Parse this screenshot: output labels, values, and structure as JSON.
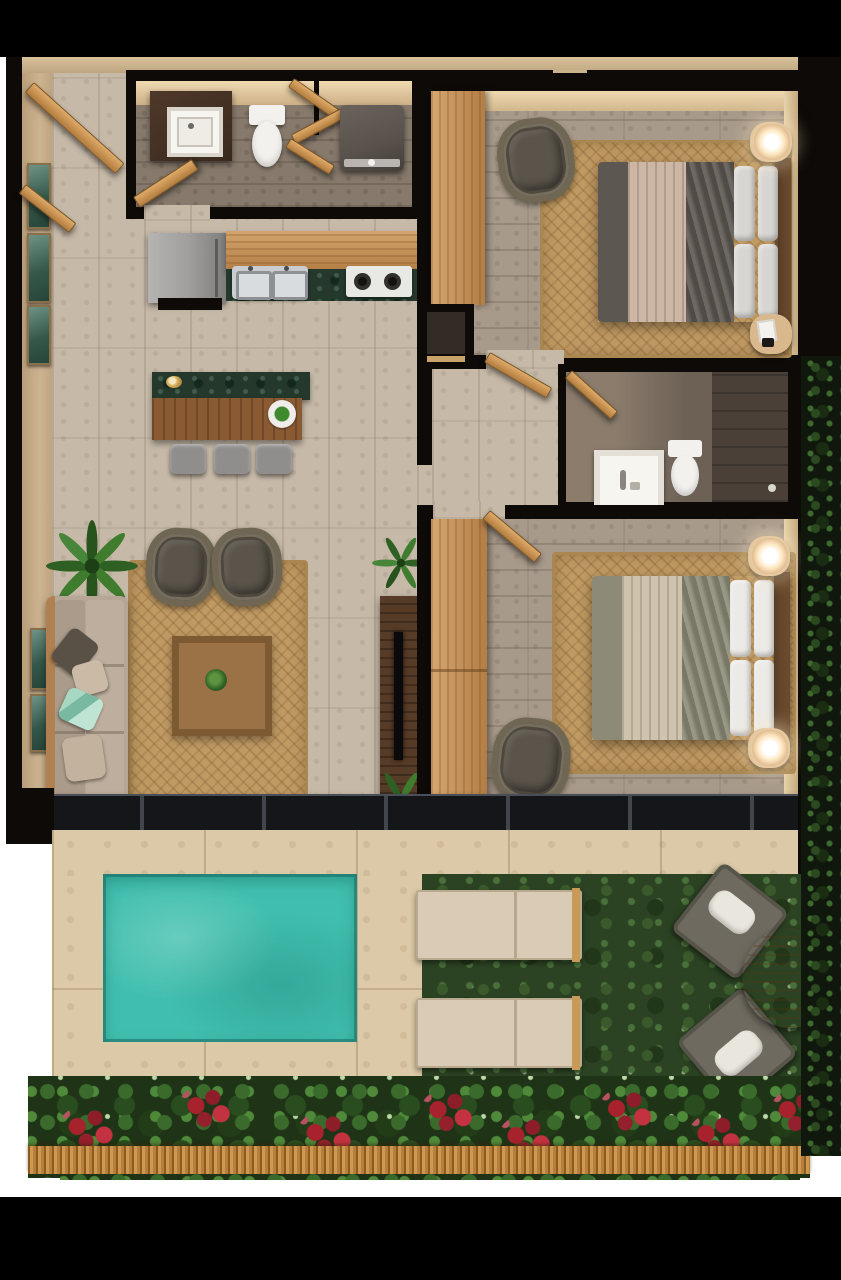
{
  "scene": {
    "description": "top-down 3D render of a two-bedroom, two-bath apartment floor plan with private plunge pool, stone terrace and landscaped garden",
    "render_type": "architectural floor plan, no text labels"
  },
  "palette": {
    "letterbox": "#000000",
    "wall": "#0d0a07",
    "wall_beige": "#cdb491",
    "wall_face": "#e6d0ab",
    "floor_living": "#c6b9a8",
    "floor_bedroom": "#a89a8a",
    "floor_bath1": "#877a6c",
    "floor_bath2": "#6d6156",
    "rug_jute": "#c09a63",
    "wood_light": "#c79054",
    "wood_mid": "#8a5a33",
    "wood_dark": "#563b26",
    "marble_green": "#24382c",
    "fridge": "#9e9d9b",
    "steel": "#c9cdcf",
    "white_fixture": "#f2f1ed",
    "washer": "#59524c",
    "sofa": "#b5a695",
    "armchair": "#4f483e",
    "bed1_duvet": "#5d5751",
    "bed1_throw": "#cdb6a4",
    "bed2_duvet": "#8d8b78",
    "bed2_throw": "#cfc3ad",
    "pillow_light": "#d8d6d2",
    "lamp_glow": "#ffe9c4",
    "tv_black": "#0a0a0a",
    "slider_dark": "#15161a",
    "deck": "#dcc9a7",
    "pool": "#41bfae",
    "grass": "#2c4323",
    "hedge": "#10180d",
    "lounger": "#d9cbb5",
    "chair_gray": "#6e6a5f",
    "cushion_white": "#e9e6de",
    "table_wood": "#b07a42",
    "flower_red": "#a8222e",
    "thatch": "#c28d4b",
    "plant_green": "#3f7a35"
  },
  "areas": {
    "entry_hall": {
      "items": [
        "entry-door-open",
        "wall-art-panels x3"
      ]
    },
    "bathroom_1": {
      "items": [
        "wood-vanity-with-square-sink",
        "toilet",
        "wood-towel-ladder",
        "washer",
        "swing-door"
      ]
    },
    "kitchen": {
      "items": [
        "refrigerator",
        "oak-counter",
        "double-steel-sink",
        "two-burner-stove",
        "green-marble-backsplash"
      ]
    },
    "dining": {
      "items": [
        "green-marble-bar",
        "wood-dining-table",
        "stools x3",
        "serving-plate",
        "flower-decor"
      ]
    },
    "living_room": {
      "items": [
        "beige-sofa",
        "throw-pillows x4",
        "potted-palm",
        "wicker-armchairs x2",
        "jute-rug",
        "wood-coffee-table-with-plant",
        "tv-console",
        "tv",
        "palm-plants x2"
      ]
    },
    "hallway": {
      "items": [
        "tall-oak-cabinet",
        "storage-niche"
      ]
    },
    "bedroom_1": {
      "items": [
        "oak-wardrobe",
        "double-bed",
        "gray-duvet",
        "blush-pleated-throw",
        "pillows x4",
        "nightstands x2",
        "glowing-lamp",
        "book",
        "wicker-armchair",
        "jute-rug",
        "swing-door"
      ]
    },
    "bathroom_2": {
      "items": [
        "framed-mirror",
        "toilet",
        "walk-in-shower-with-drain",
        "swing-door"
      ]
    },
    "bedroom_2": {
      "items": [
        "oak-wardrobe",
        "double-bed",
        "sage-duvet",
        "beige-pleated-throw",
        "pillows x4",
        "glowing-lamps x2",
        "wicker-armchair",
        "jute-rug",
        "swing-door"
      ]
    },
    "pool_terrace": {
      "items": [
        "stone-deck",
        "turquoise-plunge-pool",
        "sliding-glass-doors"
      ]
    },
    "garden": {
      "items": [
        "lawn",
        "sun-loungers x2",
        "outdoor-chairs-with-white-cushions x2",
        "round-wood-table",
        "flower-bed-green-red",
        "thatch-border",
        "side-hedge"
      ]
    }
  }
}
